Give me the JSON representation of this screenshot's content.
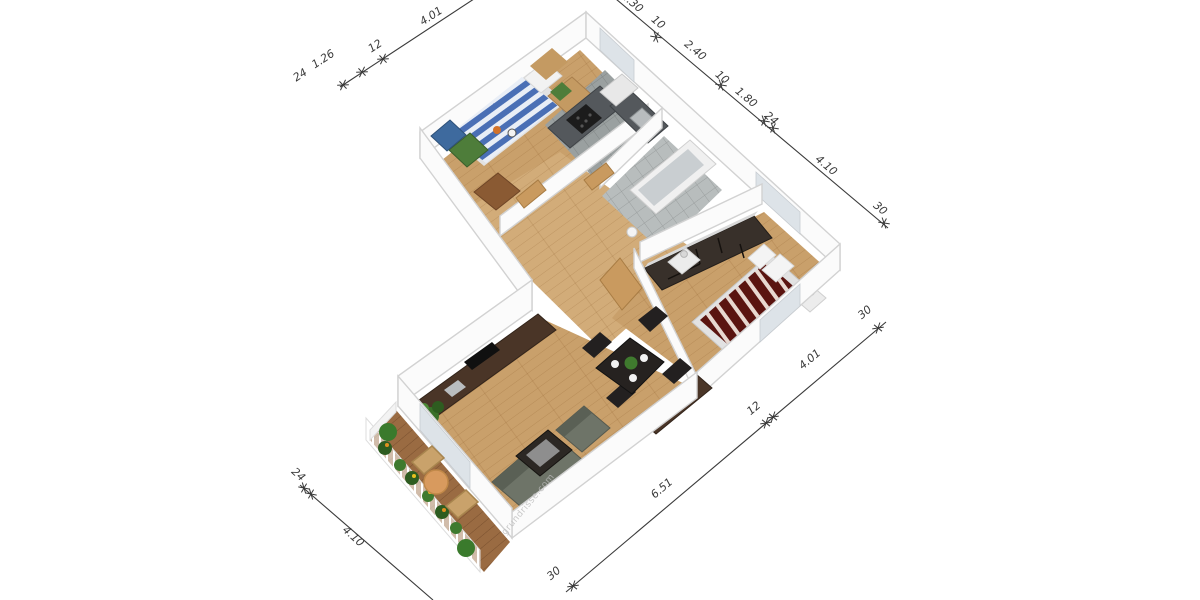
{
  "title": "3D floor plan render",
  "watermark": {
    "text": "grundrisse.com"
  },
  "palette": {
    "wall": "#fbfbfb",
    "wall_top": "#f1f1f1",
    "wall_edge": "#d2d2d2",
    "window_glass": "#dde3e8",
    "floor_wood": "#c9a06b",
    "floor_wood_light": "#d2ac79",
    "tile_kitchen": "#9aa0a0",
    "tile_bath": "#b8bdbd",
    "deck_wood": "#9a6b42",
    "bed_blue": "#4a6fb5",
    "bed_blue_light": "#e9eef6",
    "bed_red": "#5a1410",
    "bed_red_light": "#e8d8d0",
    "bed_frame": "#e2e2e2",
    "wardrobe_green": "#4e7d3a",
    "cabinet_blue": "#3e6a9e",
    "dresser_brown": "#8a5a33",
    "wood_dark": "#4a3527",
    "wardrobe_dark": "#38302a",
    "counter": "#54585c",
    "appliance_dark": "#1c1c1c",
    "fridge_white": "#e8e8e8",
    "tub_white": "#f0f0f0",
    "tub_inner": "#c9ced1",
    "sofa": "#6e7468",
    "table_dark": "#262220",
    "plant_green": "#3f7a2e",
    "plant_dark": "#2e5c20",
    "flower_orange": "#e09020",
    "patio_table": "#d89a5e",
    "patio_chair": "#c9a26b",
    "dim_color": "#3a3a3a",
    "watermark_color": "#bcbcbc"
  },
  "dimensions": {
    "top_left": {
      "labels": [
        "24",
        "1.26",
        "12",
        "4.01"
      ]
    },
    "top_right": {
      "labels": [
        "2.30",
        "10",
        "2.40",
        "10",
        "1.80",
        "24",
        "4.10",
        "30"
      ]
    },
    "bottom_right": {
      "labels": [
        "30",
        "6.51",
        "12",
        "4.01",
        "30"
      ]
    },
    "bottom_left": {
      "labels": [
        "24",
        "4.10"
      ]
    }
  }
}
